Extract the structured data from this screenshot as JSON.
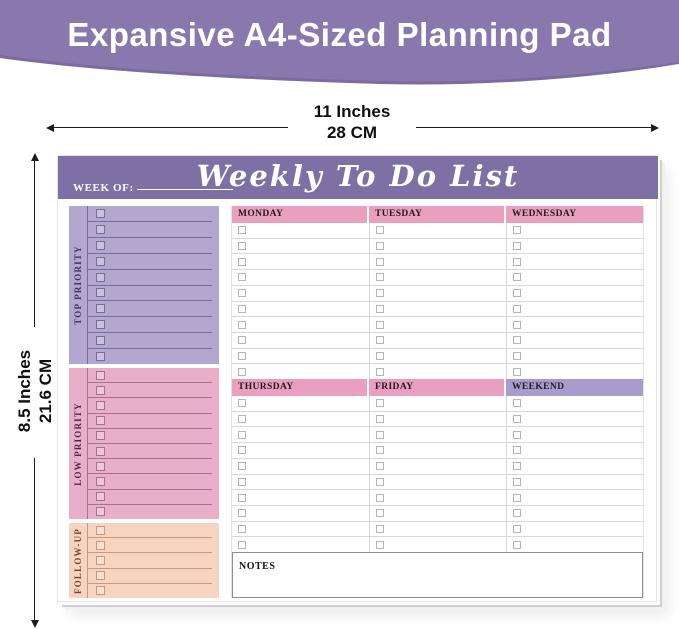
{
  "banner": {
    "title": "Expansive A4-Sized Planning Pad",
    "bg_color": "#8878ae",
    "shade_color": "#7b6ba0"
  },
  "dimensions": {
    "width_inches": "11 Inches",
    "width_cm": "28 CM",
    "height_inches": "8.5 Inches",
    "height_cm": "21.6 CM"
  },
  "pad": {
    "header": {
      "week_of_label": "WEEK OF:",
      "title": "Weekly To Do List",
      "bg_color": "#7e6fa5"
    },
    "sections": [
      {
        "label": "TOP PRIORITY",
        "rows": 10,
        "bg_color": "#b3a6cf"
      },
      {
        "label": "LOW PRIORITY",
        "rows": 10,
        "bg_color": "#e9afc8"
      },
      {
        "label": "FOLLOW-UP",
        "rows": 5,
        "bg_color": "#f8d3c0"
      }
    ],
    "week_grid": {
      "day_header_pink": "#ea9fbe",
      "day_header_purple": "#a89bce",
      "blocks": [
        {
          "days": [
            "MONDAY",
            "TUESDAY",
            "WEDNESDAY"
          ],
          "rows_per_day": 10
        },
        {
          "days": [
            "THURSDAY",
            "FRIDAY",
            "WEEKEND"
          ],
          "rows_per_day": 10
        }
      ],
      "notes_label": "NOTES"
    }
  }
}
